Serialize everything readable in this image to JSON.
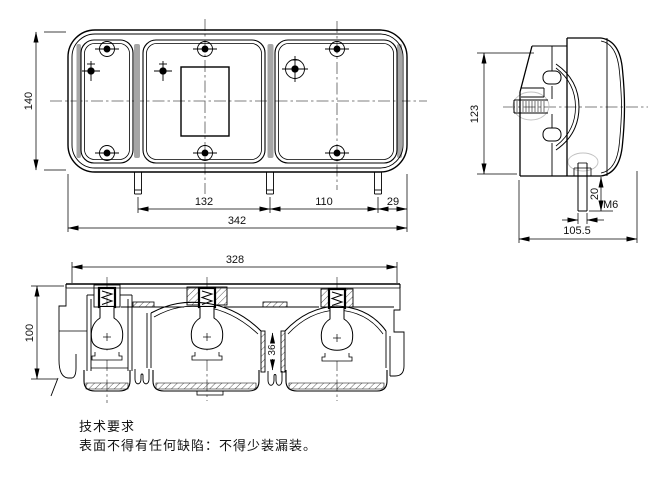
{
  "front_view": {
    "dim_height": "140",
    "dim_span_left": "132",
    "dim_span_right": "110",
    "dim_edge": "29",
    "dim_total": "342"
  },
  "side_view": {
    "dim_height": "123",
    "dim_stud_length": "20",
    "dim_thread": "M6",
    "dim_depth": "105.5"
  },
  "section_view": {
    "dim_width": "328",
    "dim_depth": "100",
    "dim_divider": "36"
  },
  "notes": {
    "heading": "技术要求",
    "body": "表面不得有任何缺陷：不得少装漏装。"
  }
}
